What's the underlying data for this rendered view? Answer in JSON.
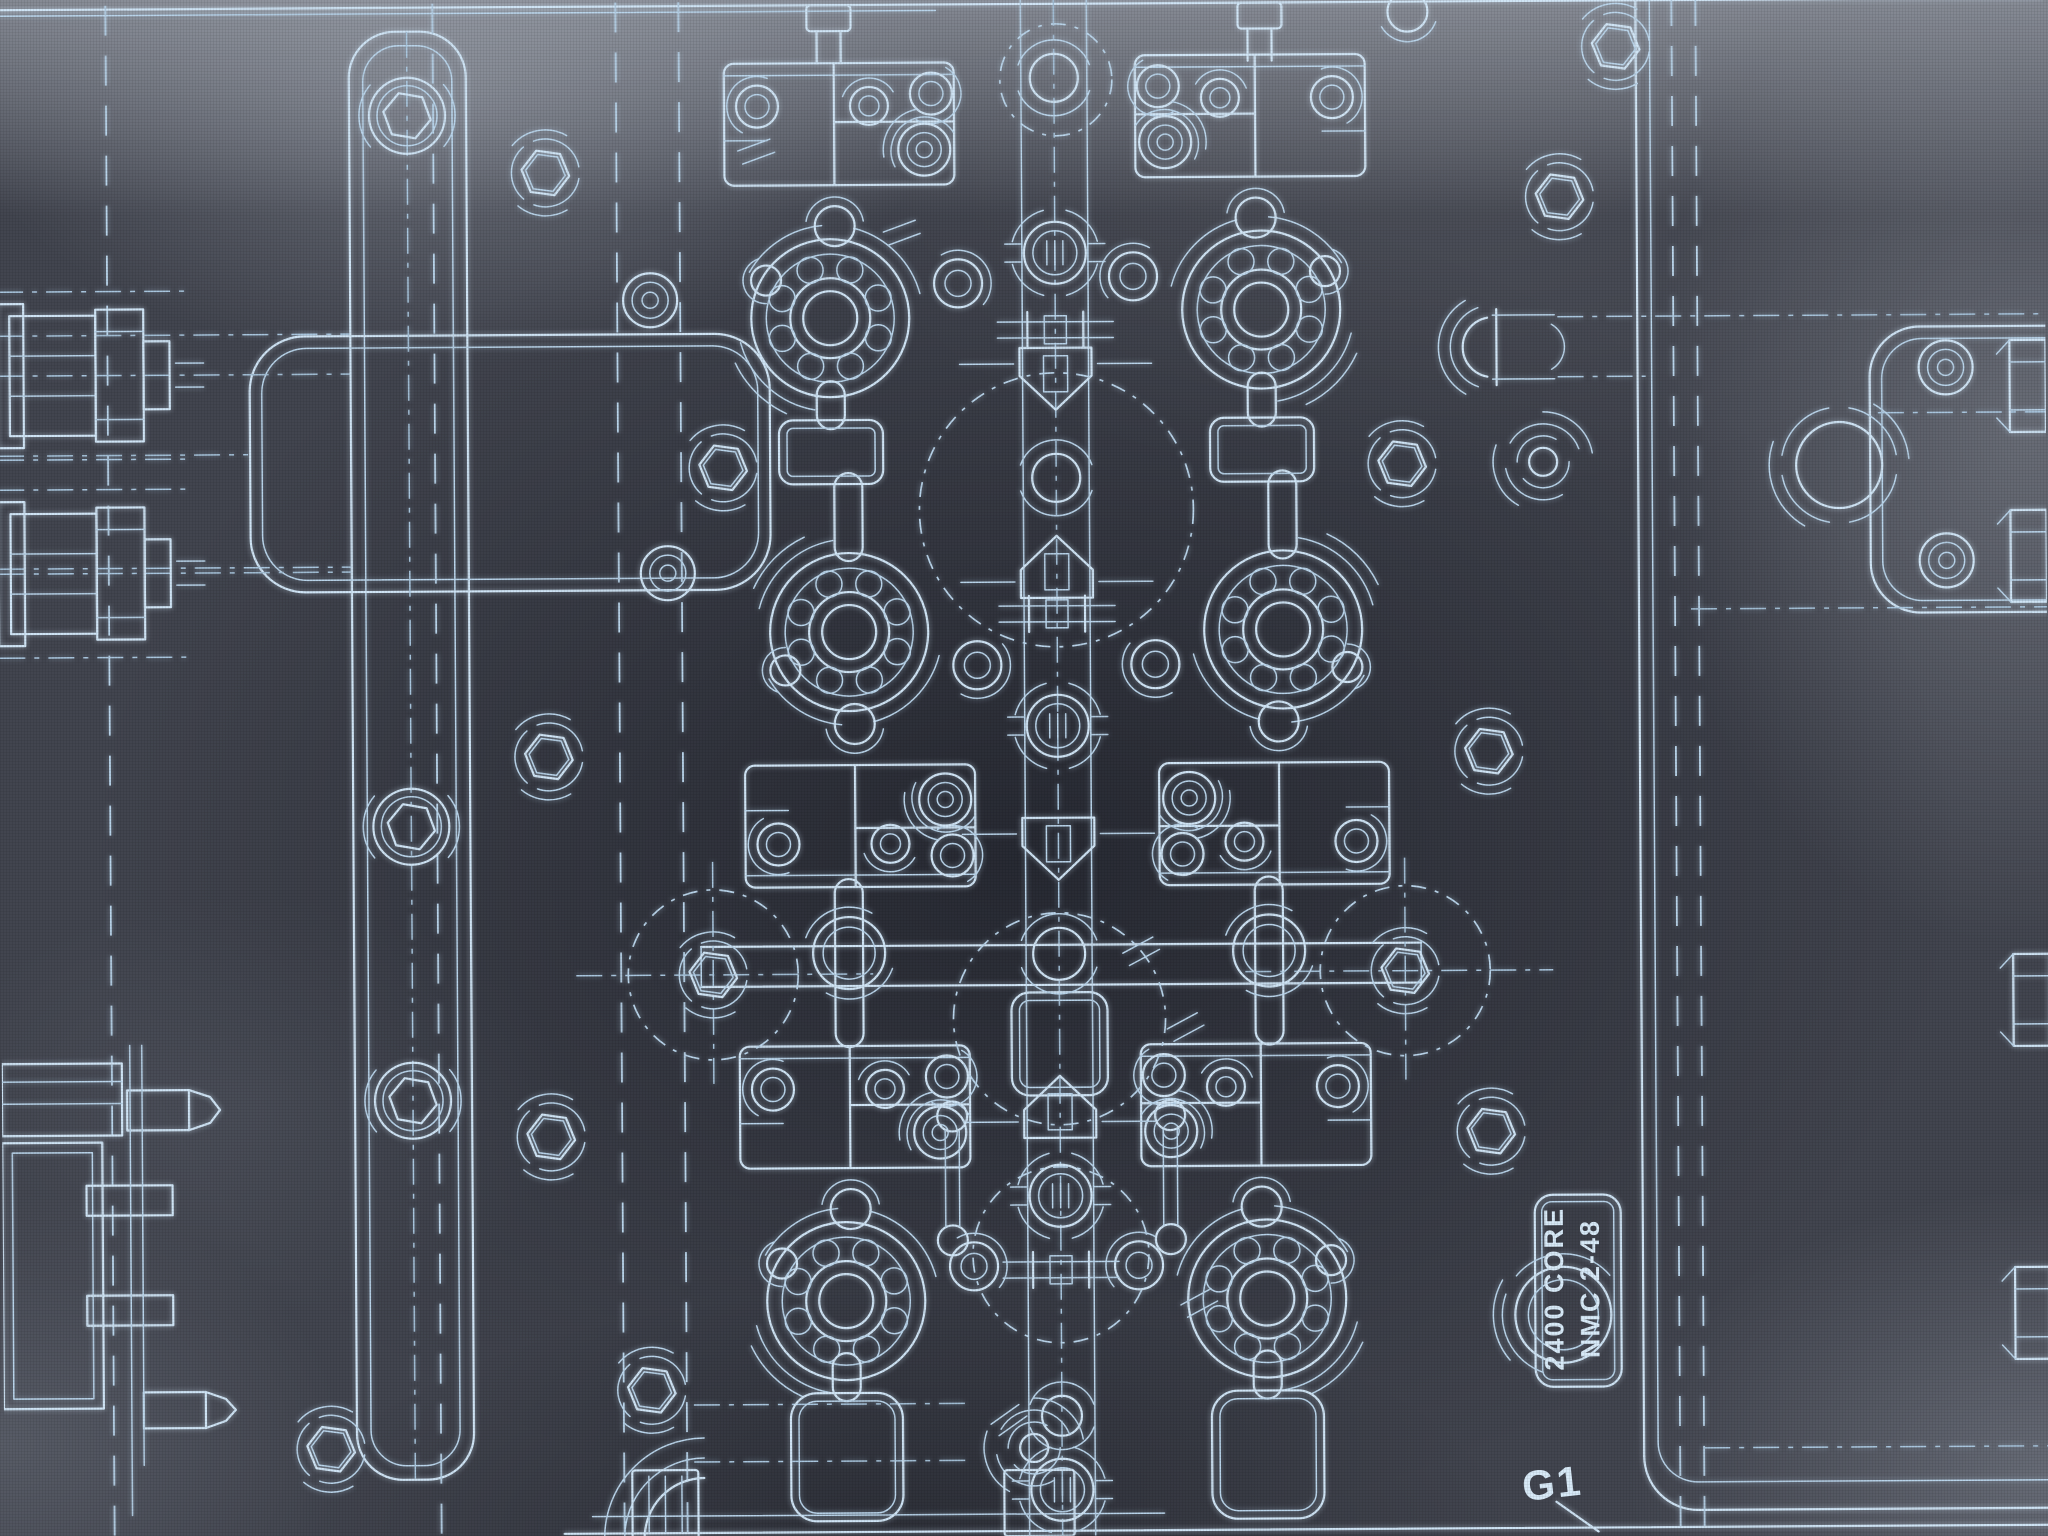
{
  "labels": {
    "part_line1": "2400 CORE",
    "part_line2": "NMC 2-48",
    "gate": "G1"
  },
  "colors": {
    "background": "#42454f",
    "background_dark_center": "#2c2f3a",
    "line": "#cfe4f5",
    "line_soft": "#b9d4ea",
    "centerline": "#a9c6de",
    "text": "#d8eaf8"
  },
  "diagram": {
    "canvas": {
      "w": 2048,
      "h": 1536
    },
    "units": [
      {
        "x": 833,
        "y": 317,
        "fx": 1,
        "fy": 1
      },
      {
        "x": 1264,
        "y": 311,
        "fx": -1,
        "fy": 1
      },
      {
        "x": 850,
        "y": 631,
        "fx": 1,
        "fy": -1
      },
      {
        "x": 1284,
        "y": 631,
        "fx": -1,
        "fy": -1
      },
      {
        "x": 843,
        "y": 1300,
        "fx": 1,
        "fy": 1
      },
      {
        "x": 1264,
        "y": 1300,
        "fx": -1,
        "fy": 1
      }
    ],
    "topStubs": [
      833,
      1264
    ],
    "pads": [
      {
        "x": 833,
        "y": 451,
        "w": 104,
        "h": 64,
        "r": 14
      },
      {
        "x": 1264,
        "y": 451,
        "w": 104,
        "h": 64,
        "r": 14
      },
      {
        "x": 843,
        "y": 1456,
        "w": 112,
        "h": 128,
        "r": 26
      },
      {
        "x": 1264,
        "y": 1456,
        "w": 112,
        "h": 128,
        "r": 26
      },
      {
        "x": 1058,
        "y": 1044,
        "w": 96,
        "h": 103,
        "r": 18
      }
    ],
    "slots": [
      {
        "x": 833,
        "y1": 380,
        "y2": 428
      },
      {
        "x": 1264,
        "y1": 374,
        "y2": 428
      },
      {
        "x": 850,
        "y1": 472,
        "y2": 560
      },
      {
        "x": 1284,
        "y1": 472,
        "y2": 560
      },
      {
        "x": 848,
        "y1": 878,
        "y2": 1046,
        "c": 952
      },
      {
        "x": 1268,
        "y1": 878,
        "y2": 1046,
        "c": 952
      },
      {
        "x": 843,
        "y1": 1352,
        "y2": 1400
      },
      {
        "x": 1264,
        "y1": 1352,
        "y2": 1400
      }
    ],
    "axis": {
      "x": 1058,
      "features": [
        {
          "t": "circle",
          "y": 78,
          "r": 24
        },
        {
          "t": "flange",
          "y": 253
        },
        {
          "t": "bar",
          "y": 330
        },
        {
          "t": "pentDown",
          "y": 378
        },
        {
          "t": "circle",
          "y": 478,
          "r": 24
        },
        {
          "t": "pentUp",
          "y": 568
        },
        {
          "t": "bar",
          "y": 614
        },
        {
          "t": "flange",
          "y": 726
        },
        {
          "t": "pentDown",
          "y": 848
        },
        {
          "t": "circle",
          "y": 954,
          "r": 26
        },
        {
          "t": "pentUp",
          "y": 1108
        },
        {
          "t": "flange",
          "y": 1196
        },
        {
          "t": "bar",
          "y": 1270
        },
        {
          "t": "circle",
          "y": 1416,
          "r": 20
        },
        {
          "t": "flange",
          "y": 1490
        }
      ]
    },
    "runnerH": {
      "y1": 945,
      "y2": 985,
      "x1": 700,
      "x2": 1420
    },
    "bigDashed": [
      [
        1058,
        510,
        137
      ],
      [
        1058,
        1019,
        106
      ],
      [
        1058,
        1255,
        88
      ],
      [
        1060,
        80,
        56
      ]
    ],
    "hexCircles": [
      [
        712,
        973,
        85
      ],
      [
        1404,
        973,
        85
      ]
    ],
    "hexnuts": [
      [
        549,
        170
      ],
      [
        1563,
        200
      ],
      [
        725,
        466
      ],
      [
        1404,
        466
      ],
      [
        549,
        754
      ],
      [
        1489,
        754
      ],
      [
        549,
        1134
      ],
      [
        1489,
        1134
      ],
      [
        1620,
        50
      ],
      [
        327,
        1445
      ],
      [
        648,
        1388
      ]
    ],
    "washers": [
      [
        653,
        298
      ],
      [
        669,
        571
      ],
      [
        1948,
        373
      ],
      [
        1948,
        566
      ]
    ],
    "swirls": [
      [
        1545,
        465
      ],
      [
        1030,
        1448
      ]
    ],
    "springs": [
      [
        1841,
        470
      ]
    ],
    "bosses": [
      [
        411,
        112
      ],
      [
        411,
        823
      ],
      [
        411,
        1097
      ]
    ],
    "links": [
      [
        950,
        1178
      ],
      [
        1168,
        1178
      ]
    ],
    "clamps": [
      370,
      568
    ],
    "pins": {
      "x": 0,
      "y": 1040
    },
    "plates": [
      {
        "x": 353,
        "y": 28,
        "w": 117,
        "h": 1448,
        "r": 46,
        "inset": 14
      },
      {
        "x": 252,
        "y": 332,
        "w": 520,
        "h": 256,
        "r": 55,
        "inset": 12
      },
      {
        "x": 1872,
        "y": 332,
        "w": 360,
        "h": 286,
        "r": 50,
        "inset": 12
      }
    ],
    "dashV": [
      620,
      683,
      1676,
      1700,
      110,
      437
    ],
    "dashH": [
      {
        "y": 330,
        "x1": 0,
        "x2": 352
      },
      {
        "y": 450,
        "x1": 0,
        "x2": 250
      },
      {
        "y": 563,
        "x1": 0,
        "x2": 352
      },
      {
        "y": 320,
        "x1": 1560,
        "x2": 2048
      },
      {
        "y": 380,
        "x1": 1560,
        "x2": 1648
      },
      {
        "y": 418,
        "x1": 1880,
        "x2": 2048
      },
      {
        "y": 613,
        "x1": 1692,
        "x2": 2048
      },
      {
        "y": 973,
        "x1": 575,
        "x2": 872
      },
      {
        "y": 973,
        "x1": 1244,
        "x2": 1552
      },
      {
        "y": 1403,
        "x1": 690,
        "x2": 962
      },
      {
        "y": 1460,
        "x1": 690,
        "x2": 962
      },
      {
        "y": 1452,
        "x1": 1700,
        "x2": 2048
      }
    ],
    "ticks": [
      [
        1140,
        952,
        62
      ],
      [
        1184,
        1028,
        62
      ],
      [
        905,
        232,
        70
      ],
      [
        1196,
        1304,
        62
      ],
      [
        760,
        150,
        70
      ],
      [
        1005,
        1420,
        55
      ]
    ],
    "edgeBolts": [
      392,
      562,
      1006,
      1319
    ],
    "blocks": [
      {
        "x": 628,
        "y": 1468,
        "w": 66,
        "h": 68,
        "hatch": true
      },
      {
        "x": 1000,
        "y": 1470,
        "w": 70,
        "h": 66,
        "hatch": false
      }
    ],
    "circlesMisc": [
      [
        1412,
        14,
        20
      ]
    ],
    "arcsD": {
      "x": 1495,
      "y": 350
    },
    "elbow": {
      "x": 700,
      "y": 1536
    },
    "labelBox": {
      "x": 1532,
      "y": 1198,
      "w": 86,
      "h": 192,
      "r": 18,
      "circle": [
        1560,
        1318,
        48
      ]
    },
    "g1": {
      "leader": [
        1552,
        1505,
        1594,
        1535
      ]
    }
  }
}
